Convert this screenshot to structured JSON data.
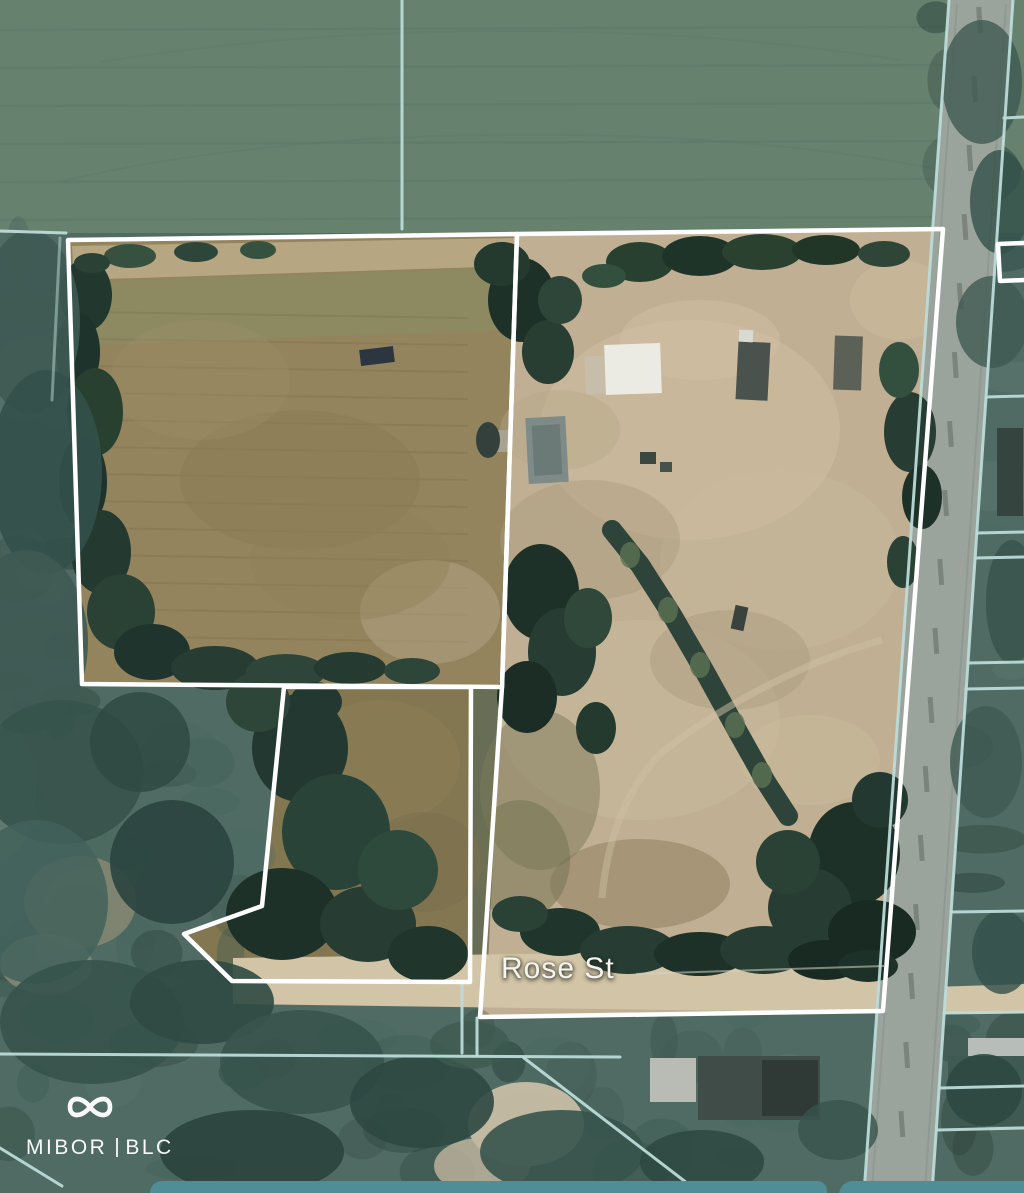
{
  "map": {
    "street_label": "Rose St"
  },
  "watermark": {
    "brand_left": "MIBOR",
    "brand_right": "BLC",
    "logo_icon": "infinity-icon"
  },
  "colors": {
    "boundary_white": "#ffffff",
    "parcel_line_teal": "#bcdbd8",
    "bottom_bar_teal": "#4f8e97",
    "field_green": "#67816f",
    "woods_green": "#4f6b64",
    "left_field_tan": "#93845e",
    "dirt_tan": "#c0af93",
    "road_gray": "#9aa49d",
    "street_label_color": "#f6f4ee"
  }
}
